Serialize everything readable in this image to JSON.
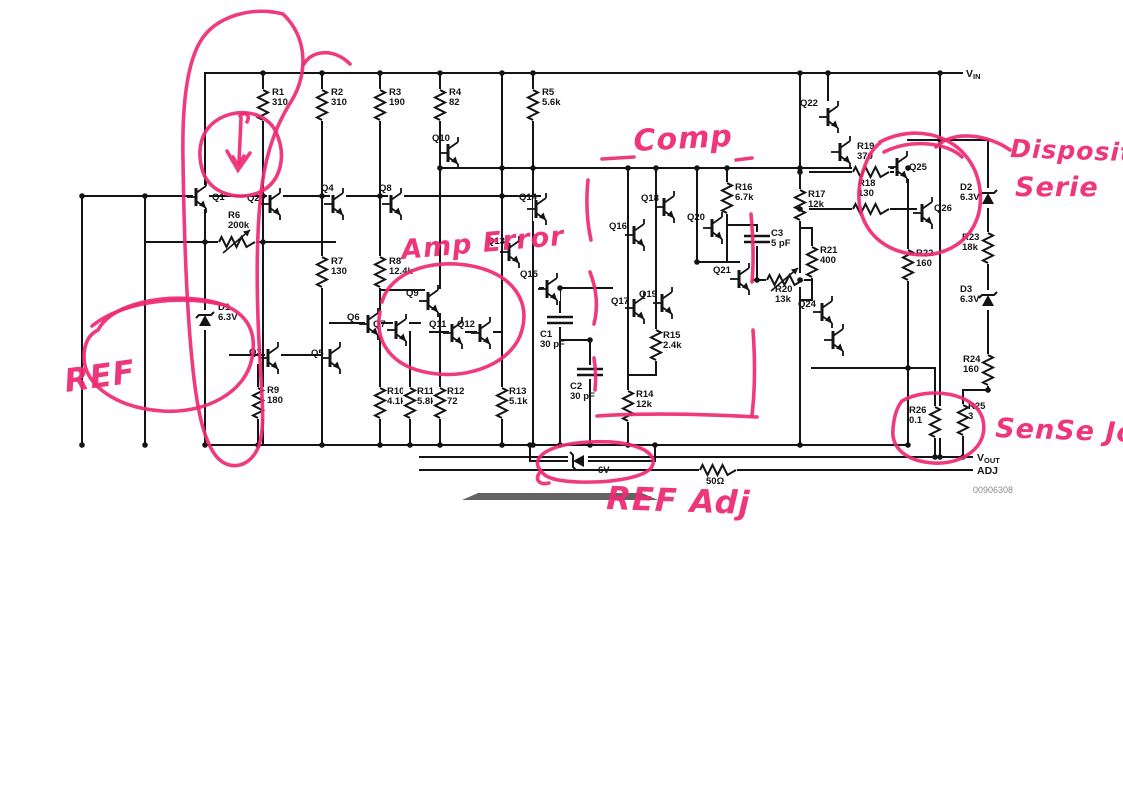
{
  "meta": {
    "figure_number": "00906308",
    "ink": "#141414",
    "annotation_color": "#ee2a72",
    "label_gray": "#8a8a8a"
  },
  "schematic": {
    "ports": [
      {
        "main": "V",
        "sub": "IN",
        "x": 966,
        "y": 77
      },
      {
        "main": "V",
        "sub": "OUT",
        "x": 977,
        "y": 461
      },
      {
        "main": "ADJ",
        "sub": "",
        "x": 977,
        "y": 474
      }
    ],
    "figure_number": {
      "text": "00906308",
      "x": 973,
      "y": 493
    },
    "wires": [
      [
        205,
        73,
        962,
        73
      ],
      [
        440,
        168,
        908,
        168
      ],
      [
        82,
        196,
        540,
        196
      ],
      [
        145,
        242,
        335,
        242
      ],
      [
        82,
        196,
        82,
        445
      ],
      [
        145,
        196,
        145,
        445
      ],
      [
        205,
        73,
        205,
        445
      ],
      [
        263,
        73,
        263,
        445
      ],
      [
        322,
        73,
        322,
        445
      ],
      [
        380,
        73,
        380,
        445
      ],
      [
        410,
        332,
        410,
        445
      ],
      [
        440,
        73,
        440,
        445
      ],
      [
        502,
        73,
        502,
        445
      ],
      [
        533,
        73,
        533,
        445
      ],
      [
        540,
        288,
        612,
        288
      ],
      [
        560,
        288,
        560,
        445
      ],
      [
        560,
        340,
        590,
        340
      ],
      [
        590,
        340,
        590,
        445
      ],
      [
        628,
        168,
        628,
        445
      ],
      [
        656,
        168,
        656,
        375
      ],
      [
        628,
        375,
        656,
        375
      ],
      [
        697,
        168,
        697,
        262
      ],
      [
        697,
        262,
        739,
        262
      ],
      [
        727,
        168,
        727,
        262
      ],
      [
        757,
        225,
        757,
        253
      ],
      [
        727,
        225,
        757,
        225
      ],
      [
        757,
        253,
        757,
        280
      ],
      [
        745,
        280,
        812,
        280
      ],
      [
        800,
        73,
        800,
        445
      ],
      [
        812,
        228,
        812,
        300
      ],
      [
        800,
        228,
        812,
        228
      ],
      [
        800,
        300,
        812,
        300
      ],
      [
        828,
        73,
        828,
        100
      ],
      [
        810,
        172,
        853,
        172
      ],
      [
        889,
        172,
        895,
        172
      ],
      [
        810,
        209,
        853,
        209
      ],
      [
        889,
        209,
        916,
        209
      ],
      [
        908,
        180,
        908,
        445
      ],
      [
        908,
        140,
        940,
        140
      ],
      [
        940,
        73,
        940,
        457
      ],
      [
        940,
        140,
        988,
        140
      ],
      [
        988,
        140,
        988,
        390
      ],
      [
        963,
        390,
        988,
        390
      ],
      [
        963,
        390,
        963,
        457
      ],
      [
        812,
        368,
        935,
        368
      ],
      [
        935,
        368,
        935,
        457
      ],
      [
        205,
        445,
        908,
        445
      ],
      [
        420,
        457,
        972,
        457
      ],
      [
        420,
        470,
        972,
        470
      ],
      [
        530,
        445,
        530,
        461
      ],
      [
        655,
        445,
        655,
        461
      ],
      [
        530,
        461,
        655,
        461
      ],
      [
        330,
        323,
        420,
        323
      ],
      [
        430,
        332,
        500,
        332
      ],
      [
        230,
        355,
        322,
        355
      ],
      [
        380,
        290,
        440,
        290
      ],
      [
        258,
        365,
        258,
        445
      ]
    ],
    "dots": [
      [
        263,
        73
      ],
      [
        322,
        73
      ],
      [
        380,
        73
      ],
      [
        440,
        73
      ],
      [
        502,
        73
      ],
      [
        533,
        73
      ],
      [
        800,
        73
      ],
      [
        828,
        73
      ],
      [
        940,
        73
      ],
      [
        440,
        168
      ],
      [
        502,
        168
      ],
      [
        533,
        168
      ],
      [
        628,
        168
      ],
      [
        656,
        168
      ],
      [
        697,
        168
      ],
      [
        727,
        168
      ],
      [
        800,
        168
      ],
      [
        908,
        168
      ],
      [
        82,
        196
      ],
      [
        145,
        196
      ],
      [
        263,
        196
      ],
      [
        322,
        196
      ],
      [
        380,
        196
      ],
      [
        502,
        196
      ],
      [
        205,
        242
      ],
      [
        263,
        242
      ],
      [
        560,
        288
      ],
      [
        590,
        340
      ],
      [
        697,
        262
      ],
      [
        757,
        280
      ],
      [
        800,
        280
      ],
      [
        800,
        172
      ],
      [
        800,
        209
      ],
      [
        940,
        140
      ],
      [
        908,
        368
      ],
      [
        988,
        390
      ],
      [
        82,
        445
      ],
      [
        145,
        445
      ],
      [
        205,
        445
      ],
      [
        258,
        445
      ],
      [
        322,
        445
      ],
      [
        380,
        445
      ],
      [
        410,
        445
      ],
      [
        440,
        445
      ],
      [
        502,
        445
      ],
      [
        533,
        445
      ],
      [
        560,
        445
      ],
      [
        590,
        445
      ],
      [
        628,
        445
      ],
      [
        530,
        445
      ],
      [
        655,
        445
      ],
      [
        800,
        445
      ],
      [
        908,
        445
      ],
      [
        935,
        457
      ],
      [
        963,
        457
      ],
      [
        940,
        457
      ]
    ],
    "resistors": [
      {
        "id": "R1",
        "val": "310",
        "x": 263,
        "y": 105,
        "o": "v",
        "lx": 272,
        "ly": 95
      },
      {
        "id": "R2",
        "val": "310",
        "x": 322,
        "y": 105,
        "o": "v",
        "lx": 331,
        "ly": 95
      },
      {
        "id": "R3",
        "val": "190",
        "x": 380,
        "y": 105,
        "o": "v",
        "lx": 389,
        "ly": 95
      },
      {
        "id": "R4",
        "val": "82",
        "x": 440,
        "y": 105,
        "o": "v",
        "lx": 449,
        "ly": 95
      },
      {
        "id": "R5",
        "val": "5.6k",
        "x": 533,
        "y": 105,
        "o": "v",
        "lx": 542,
        "ly": 95
      },
      {
        "id": "R6",
        "val": "200k",
        "x": 237,
        "y": 242,
        "o": "h",
        "lx": 228,
        "ly": 218,
        "adj": true
      },
      {
        "id": "R7",
        "val": "130",
        "x": 322,
        "y": 272,
        "o": "v",
        "lx": 331,
        "ly": 264
      },
      {
        "id": "R8",
        "val": "12.4k",
        "x": 380,
        "y": 272,
        "o": "v",
        "lx": 389,
        "ly": 264
      },
      {
        "id": "R9",
        "val": "180",
        "x": 258,
        "y": 403,
        "o": "v",
        "lx": 267,
        "ly": 393
      },
      {
        "id": "R10",
        "val": "4.1k",
        "x": 380,
        "y": 403,
        "o": "v",
        "lx": 387,
        "ly": 394
      },
      {
        "id": "R11",
        "val": "5.8k",
        "x": 410,
        "y": 403,
        "o": "v",
        "lx": 417,
        "ly": 394
      },
      {
        "id": "R12",
        "val": "72",
        "x": 440,
        "y": 403,
        "o": "v",
        "lx": 447,
        "ly": 394
      },
      {
        "id": "R13",
        "val": "5.1k",
        "x": 502,
        "y": 403,
        "o": "v",
        "lx": 509,
        "ly": 394
      },
      {
        "id": "R14",
        "val": "12k",
        "x": 628,
        "y": 406,
        "o": "v",
        "lx": 636,
        "ly": 397
      },
      {
        "id": "R15",
        "val": "2.4k",
        "x": 656,
        "y": 345,
        "o": "v",
        "lx": 663,
        "ly": 338
      },
      {
        "id": "R16",
        "val": "6.7k",
        "x": 727,
        "y": 198,
        "o": "v",
        "lx": 735,
        "ly": 190
      },
      {
        "id": "R17",
        "val": "12k",
        "x": 800,
        "y": 205,
        "o": "v",
        "lx": 808,
        "ly": 197
      },
      {
        "id": "R19",
        "val": "370",
        "x": 871,
        "y": 172,
        "o": "h",
        "lx": 857,
        "ly": 149
      },
      {
        "id": "R18",
        "val": "130",
        "x": 871,
        "y": 209,
        "o": "h",
        "lx": 858,
        "ly": 186
      },
      {
        "id": "R20",
        "val": "13k",
        "x": 785,
        "y": 280,
        "o": "h",
        "lx": 775,
        "ly": 292,
        "adj": true
      },
      {
        "id": "R21",
        "val": "400",
        "x": 812,
        "y": 262,
        "o": "v",
        "lx": 820,
        "ly": 253
      },
      {
        "id": "R22",
        "val": "160",
        "x": 908,
        "y": 265,
        "o": "v",
        "lx": 916,
        "ly": 256
      },
      {
        "id": "R23",
        "val": "18k",
        "x": 988,
        "y": 248,
        "o": "v",
        "lx": 962,
        "ly": 240
      },
      {
        "id": "R24",
        "val": "160",
        "x": 988,
        "y": 370,
        "o": "v",
        "lx": 963,
        "ly": 362
      },
      {
        "id": "R25",
        "val": "3",
        "x": 963,
        "y": 420,
        "o": "v",
        "lx": 968,
        "ly": 409
      },
      {
        "id": "R26",
        "val": "0.1",
        "x": 935,
        "y": 422,
        "o": "v",
        "lx": 909,
        "ly": 413
      },
      {
        "id": "50Ω",
        "val": "",
        "x": 718,
        "y": 470,
        "o": "h",
        "lx": 706,
        "ly": 484
      }
    ],
    "capacitors": [
      {
        "id": "C1",
        "val": "30 pF",
        "x": 560,
        "y": 320,
        "lx": 540,
        "ly": 337
      },
      {
        "id": "C2",
        "val": "30 pF",
        "x": 590,
        "y": 372,
        "lx": 570,
        "ly": 389
      },
      {
        "id": "C3",
        "val": "5 pF",
        "x": 757,
        "y": 239,
        "lx": 771,
        "ly": 236
      }
    ],
    "zeners": [
      {
        "id": "D1",
        "val": "6.3V",
        "x": 205,
        "y": 320,
        "o": "v",
        "lx": 218,
        "ly": 310
      },
      {
        "id": "D2",
        "val": "6.3V",
        "x": 988,
        "y": 198,
        "o": "v",
        "lx": 960,
        "ly": 190
      },
      {
        "id": "D3",
        "val": "6.3V",
        "x": 988,
        "y": 300,
        "o": "v",
        "lx": 960,
        "ly": 292
      },
      {
        "id": "",
        "val": "6V",
        "x": 578,
        "y": 461,
        "o": "h",
        "lx": 598,
        "ly": 473
      }
    ],
    "transistors": [
      {
        "id": "Q1",
        "x": 196,
        "y": 197,
        "lx": 212,
        "ly": 200
      },
      {
        "id": "Q2",
        "x": 270,
        "y": 204,
        "lx": 247,
        "ly": 201
      },
      {
        "id": "Q3",
        "x": 268,
        "y": 358,
        "lx": 249,
        "ly": 355
      },
      {
        "id": "Q4",
        "x": 333,
        "y": 204,
        "lx": 321,
        "ly": 191
      },
      {
        "id": "Q5",
        "x": 330,
        "y": 358,
        "lx": 311,
        "ly": 356
      },
      {
        "id": "Q6",
        "x": 368,
        "y": 324,
        "lx": 347,
        "ly": 320
      },
      {
        "id": "Q7",
        "x": 396,
        "y": 330,
        "lx": 373,
        "ly": 327
      },
      {
        "id": "Q8",
        "x": 391,
        "y": 204,
        "lx": 379,
        "ly": 191
      },
      {
        "id": "Q9",
        "x": 428,
        "y": 301,
        "lx": 406,
        "ly": 296
      },
      {
        "id": "Q10",
        "x": 448,
        "y": 153,
        "lx": 432,
        "ly": 141
      },
      {
        "id": "Q11",
        "x": 452,
        "y": 333,
        "lx": 429,
        "ly": 327
      },
      {
        "id": "Q12",
        "x": 480,
        "y": 333,
        "lx": 457,
        "ly": 327
      },
      {
        "id": "Q13",
        "x": 509,
        "y": 252,
        "lx": 487,
        "ly": 244
      },
      {
        "id": "Q14",
        "x": 536,
        "y": 209,
        "lx": 519,
        "ly": 200
      },
      {
        "id": "Q15",
        "x": 547,
        "y": 289,
        "lx": 520,
        "ly": 277
      },
      {
        "id": "Q16",
        "x": 634,
        "y": 235,
        "lx": 609,
        "ly": 229
      },
      {
        "id": "Q17",
        "x": 634,
        "y": 308,
        "lx": 611,
        "ly": 304
      },
      {
        "id": "Q18",
        "x": 664,
        "y": 207,
        "lx": 641,
        "ly": 201
      },
      {
        "id": "Q19",
        "x": 662,
        "y": 303,
        "lx": 639,
        "ly": 297
      },
      {
        "id": "Q20",
        "x": 712,
        "y": 228,
        "lx": 687,
        "ly": 220
      },
      {
        "id": "Q21",
        "x": 739,
        "y": 279,
        "lx": 713,
        "ly": 273
      },
      {
        "id": "Q22",
        "x": 828,
        "y": 117,
        "lx": 800,
        "ly": 106
      },
      {
        "id": "",
        "x": 840,
        "y": 152,
        "lx": 0,
        "ly": 0
      },
      {
        "id": "Q24",
        "x": 822,
        "y": 312,
        "lx": 798,
        "ly": 307
      },
      {
        "id": "",
        "x": 833,
        "y": 340,
        "lx": 0,
        "ly": 0
      },
      {
        "id": "Q25",
        "x": 897,
        "y": 167,
        "lx": 909,
        "ly": 170
      },
      {
        "id": "Q26",
        "x": 922,
        "y": 213,
        "lx": 934,
        "ly": 211
      }
    ],
    "redaction_bar": {
      "path": "M 462 500 L 478 493 L 642 493 L 658 500 Z",
      "color": "#4d4d4d"
    }
  },
  "annotations": {
    "texts": [
      {
        "t": "REF",
        "x": 66,
        "y": 392,
        "s": 32,
        "r": -8
      },
      {
        "t": "Amp Error",
        "x": 402,
        "y": 259,
        "s": 27,
        "r": -5
      },
      {
        "t": "Comp",
        "x": 634,
        "y": 151,
        "s": 30,
        "r": -3
      },
      {
        "t": "REF Adj",
        "x": 606,
        "y": 509,
        "s": 32,
        "r": 2
      },
      {
        "t": "Dispositivo",
        "x": 1010,
        "y": 157,
        "s": 25,
        "r": 2
      },
      {
        "t": "Serie",
        "x": 1015,
        "y": 196,
        "s": 27,
        "r": 0
      },
      {
        "t": "SenSe Jo",
        "x": 995,
        "y": 437,
        "s": 27,
        "r": 2
      }
    ],
    "strokes": [
      {
        "name": "loop-around-q1-q2-column",
        "d": "M 283 14 C 252 6 215 16 200 42 C 186 66 182 110 183 160 C 184 230 186 300 192 360 C 196 402 202 438 216 456 C 228 471 248 468 257 450 C 266 432 262 400 260 360 C 256 295 256 230 262 185 C 267 148 278 122 292 100 C 306 77 310 40 283 14"
      },
      {
        "name": "loop-top-hook",
        "d": "M 350 64 C 334 48 312 50 304 64"
      },
      {
        "name": "inner-circle",
        "d": "M 212 124 C 232 106 266 110 276 132 C 287 156 281 182 260 192 C 238 202 210 193 203 172 C 197 154 200 136 210 126"
      },
      {
        "name": "inner-arrow-shaft",
        "d": "M 240 116 C 244 111 251 114 247 122 M 241 118 L 239 163"
      },
      {
        "name": "inner-arrow-head",
        "d": "M 227 151 L 238 170 L 250 153 M 233 157 L 238 166 L 244 156"
      },
      {
        "name": "ref-circle",
        "d": "M 98 330 C 112 304 160 294 204 300 C 244 306 258 328 252 358 C 246 392 206 414 162 411 C 118 408 84 386 84 357 C 84 342 90 334 98 330"
      },
      {
        "name": "ref-arc",
        "d": "M 92 326 C 124 300 186 294 228 306"
      },
      {
        "name": "amp-error-ellipse",
        "d": "M 382 302 C 390 272 432 258 472 266 C 512 274 530 300 522 330 C 514 362 470 380 430 373 C 392 367 374 342 380 312"
      },
      {
        "name": "comp-dash-left",
        "d": "M 602 159 L 634 157"
      },
      {
        "name": "comp-dash-right",
        "d": "M 736 160 L 752 158"
      },
      {
        "name": "comp-bracket-l1",
        "d": "M 588 180 C 586 200 587 222 591 240"
      },
      {
        "name": "comp-bracket-l2",
        "d": "M 590 272 C 597 290 598 308 594 324"
      },
      {
        "name": "comp-bracket-l3",
        "d": "M 594 358 C 596 370 596 380 595 390"
      },
      {
        "name": "comp-bracket-r1",
        "d": "M 751 214 C 753 236 754 260 752 282"
      },
      {
        "name": "comp-bracket-r2",
        "d": "M 753 330 C 755 358 755 390 752 415"
      },
      {
        "name": "comp-bracket-bottom",
        "d": "M 597 416 C 640 413 700 414 757 417"
      },
      {
        "name": "ref-adj-circle",
        "d": "M 541 471 C 529 458 548 444 589 442 C 630 440 656 450 653 464 C 650 477 614 483 579 482 C 553 481 545 477 541 471"
      },
      {
        "name": "ref-adj-tail",
        "d": "M 541 471 C 534 478 538 486 549 483"
      },
      {
        "name": "series-device-circle",
        "d": "M 880 142 C 922 120 974 140 980 190 C 985 234 950 260 911 254 C 872 248 852 216 861 178 C 866 160 871 150 880 143"
      },
      {
        "name": "series-device-arc",
        "d": "M 884 152 C 912 138 948 143 962 157"
      },
      {
        "name": "series-device-tail",
        "d": "M 1010 150 C 988 134 952 130 936 147"
      },
      {
        "name": "sense-circle",
        "d": "M 902 401 C 928 386 976 392 983 420 C 989 447 962 465 933 463 C 906 461 891 448 893 429 C 894 416 897 407 902 401"
      }
    ]
  }
}
